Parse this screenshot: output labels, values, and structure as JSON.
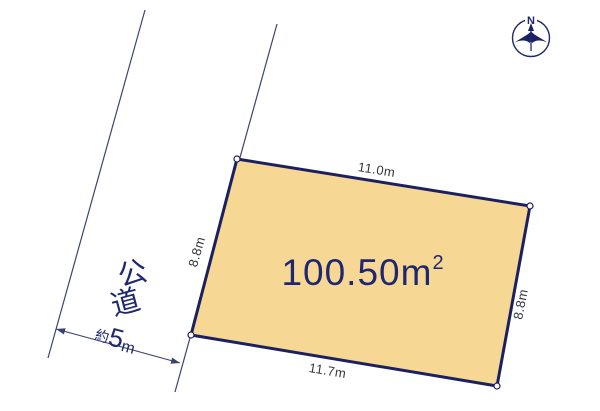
{
  "diagram": {
    "type": "land-plot-layout",
    "plot": {
      "area_number": "100.50",
      "area_unit": "m",
      "area_unit_exponent": "2",
      "edges": {
        "top": "11.0m",
        "left": "8.8m",
        "right": "8.8m",
        "bottom": "11.7m"
      }
    },
    "road": {
      "label": "公道",
      "label_char_1": "公",
      "label_char_2": "道",
      "width_prefix": "約",
      "width_value": "5",
      "width_unit": "m"
    },
    "compass": {
      "north_label": "N"
    },
    "colors": {
      "background": "#FFFFFF",
      "plot_fill": "#F6D894",
      "plot_border": "#1B2060",
      "navy_text": "#1E2770",
      "dimension_text": "#33363A",
      "thin_line": "#3D4370"
    }
  }
}
